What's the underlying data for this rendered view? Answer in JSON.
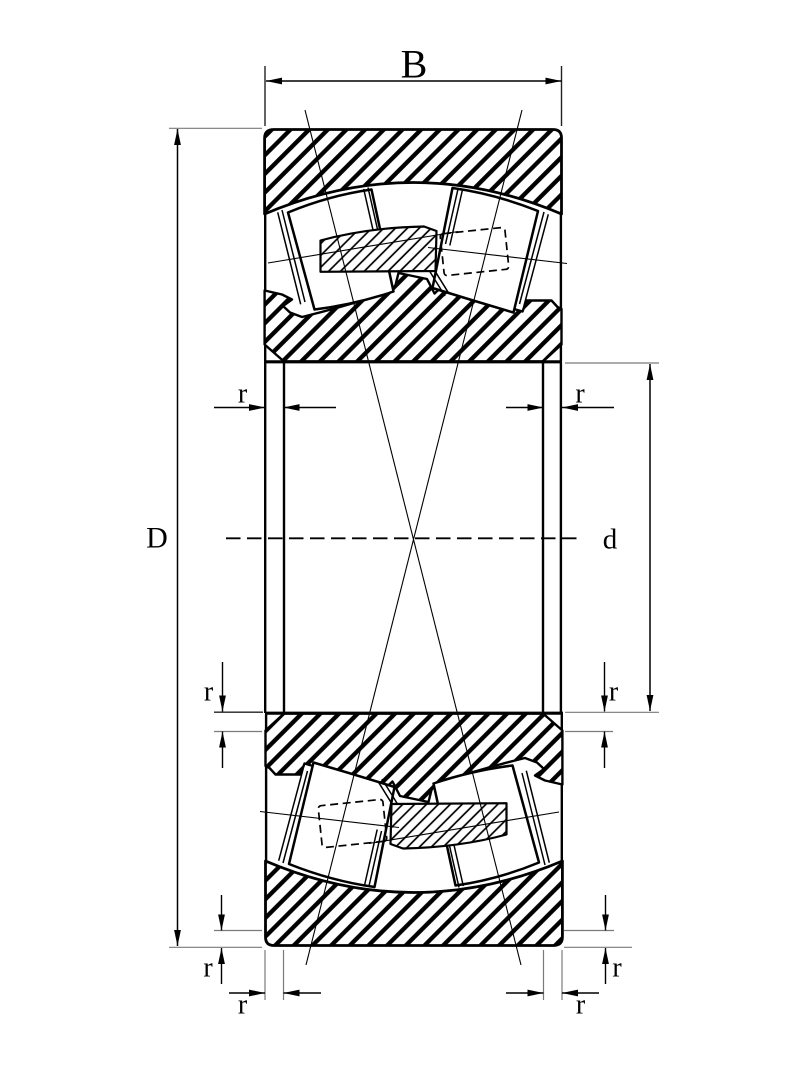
{
  "drawing": {
    "title": "Spherical roller bearing cross-section dimension drawing",
    "dimension_labels": {
      "width": "B",
      "outer_diameter": "D",
      "bore_diameter": "d",
      "chamfer": "r"
    },
    "colors": {
      "line": "#000000",
      "background": "#ffffff",
      "extension_line": "#7a7a7a"
    }
  }
}
